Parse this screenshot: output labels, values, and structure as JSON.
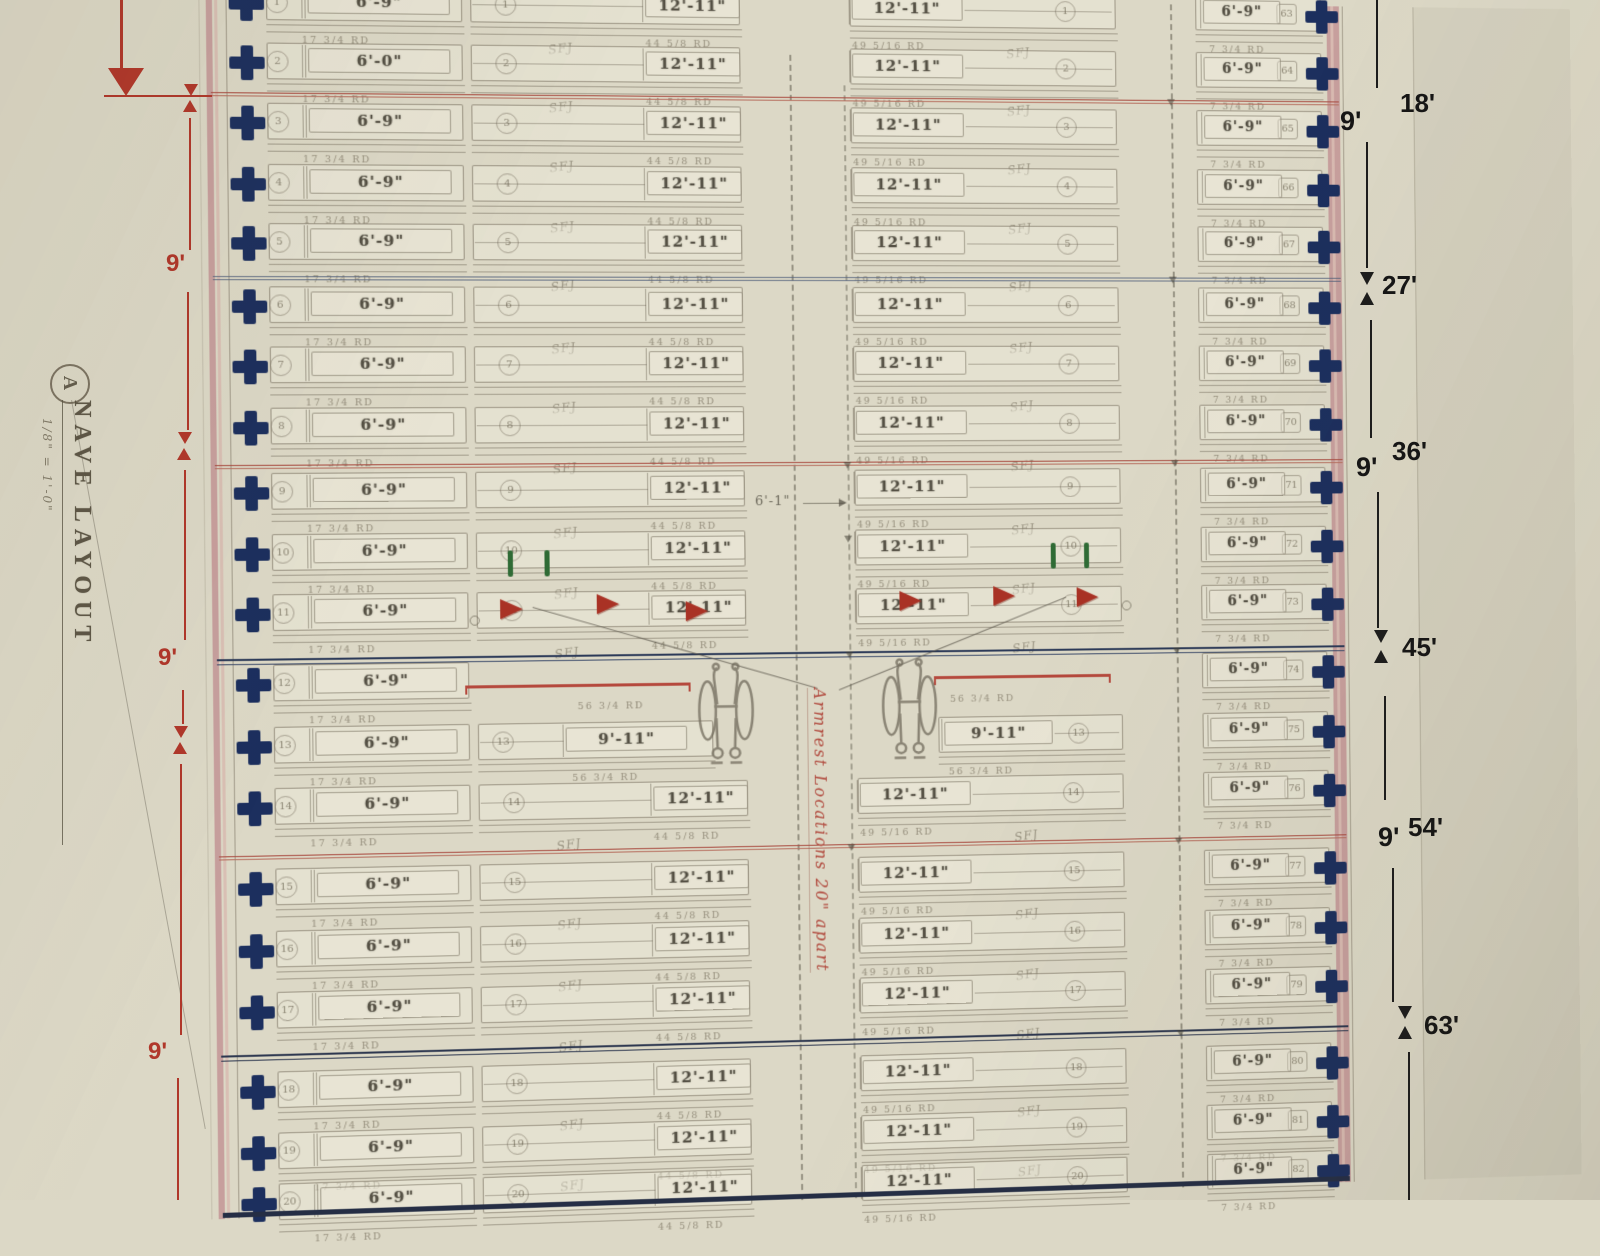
{
  "sheet": {
    "title_block": {
      "detail_letter": "A",
      "title": "NAVE LAYOUT",
      "scale": "1/8\" = 1'-0\""
    },
    "center_aisle_note": "Armrest Locations 20\" apart",
    "aisle_dimension_label": "6'-1\"",
    "between_row_mark": "SFJ"
  },
  "left_dimension_chain": {
    "segment_labels": [
      "9'",
      "9'",
      "9'"
    ]
  },
  "right_dimension_chain": {
    "marks": [
      {
        "cumulative": "18'",
        "segment": "9'"
      },
      {
        "cumulative": "27'"
      },
      {
        "cumulative": "36'",
        "segment": "9'"
      },
      {
        "cumulative": "45'"
      },
      {
        "cumulative": "54'",
        "segment": "9'"
      },
      {
        "cumulative": "63'"
      }
    ]
  },
  "pew_rows": [
    {
      "left": {
        "num": "1",
        "label": "6'-9\"",
        "sub": "17 3/4 RD"
      },
      "center_left": {
        "num": "1",
        "label": "12'-11\"",
        "sub": "44 5/8 RD"
      },
      "center_right": {
        "label": "12'-11\"",
        "num": "1",
        "sub": "49 5/16 RD"
      },
      "right": {
        "label": "6'-9\"",
        "num": "63",
        "sub": "7 3/4 RD"
      },
      "sfj": true
    },
    {
      "left": {
        "num": "2",
        "label": "6'-0\"",
        "sub": "17 3/4 RD"
      },
      "center_left": {
        "num": "2",
        "label": "12'-11\"",
        "sub": "44 5/8 RD"
      },
      "center_right": {
        "label": "12'-11\"",
        "num": "2",
        "sub": "49 5/16 RD"
      },
      "right": {
        "label": "6'-9\"",
        "num": "64",
        "sub": "7 3/4 RD"
      },
      "sfj": true
    },
    {
      "left": {
        "num": "3",
        "label": "6'-9\"",
        "sub": "17 3/4 RD"
      },
      "center_left": {
        "num": "3",
        "label": "12'-11\"",
        "sub": "44 5/8 RD"
      },
      "center_right": {
        "label": "12'-11\"",
        "num": "3",
        "sub": "49 5/16 RD"
      },
      "right": {
        "label": "6'-9\"",
        "num": "65",
        "sub": "7 3/4 RD"
      },
      "sfj": true
    },
    {
      "left": {
        "num": "4",
        "label": "6'-9\"",
        "sub": "17 3/4 RD"
      },
      "center_left": {
        "num": "4",
        "label": "12'-11\"",
        "sub": "44 5/8 RD"
      },
      "center_right": {
        "label": "12'-11\"",
        "num": "4",
        "sub": "49 5/16 RD"
      },
      "right": {
        "label": "6'-9\"",
        "num": "66",
        "sub": "7 3/4 RD"
      },
      "sfj": true
    },
    {
      "left": {
        "num": "5",
        "label": "6'-9\"",
        "sub": "17 3/4 RD"
      },
      "center_left": {
        "num": "5",
        "label": "12'-11\"",
        "sub": "44 5/8 RD"
      },
      "center_right": {
        "label": "12'-11\"",
        "num": "5",
        "sub": "49 5/16 RD"
      },
      "right": {
        "label": "6'-9\"",
        "num": "67",
        "sub": "7 3/4 RD"
      },
      "sfj": true
    },
    {
      "left": {
        "num": "6",
        "label": "6'-9\"",
        "sub": "17 3/4 RD"
      },
      "center_left": {
        "num": "6",
        "label": "12'-11\"",
        "sub": "44 5/8 RD"
      },
      "center_right": {
        "label": "12'-11\"",
        "num": "6",
        "sub": "49 5/16 RD"
      },
      "right": {
        "label": "6'-9\"",
        "num": "68",
        "sub": "7 3/4 RD"
      },
      "sfj": true
    },
    {
      "left": {
        "num": "7",
        "label": "6'-9\"",
        "sub": "17 3/4 RD"
      },
      "center_left": {
        "num": "7",
        "label": "12'-11\"",
        "sub": "44 5/8 RD"
      },
      "center_right": {
        "label": "12'-11\"",
        "num": "7",
        "sub": "49 5/16 RD"
      },
      "right": {
        "label": "6'-9\"",
        "num": "69",
        "sub": "7 3/4 RD"
      },
      "sfj": true
    },
    {
      "left": {
        "num": "8",
        "label": "6'-9\"",
        "sub": "17 3/4 RD"
      },
      "center_left": {
        "num": "8",
        "label": "12'-11\"",
        "sub": "44 5/8 RD"
      },
      "center_right": {
        "label": "12'-11\"",
        "num": "8",
        "sub": "49 5/16 RD"
      },
      "right": {
        "label": "6'-9\"",
        "num": "70",
        "sub": "7 3/4 RD"
      },
      "sfj": true
    },
    {
      "left": {
        "num": "9",
        "label": "6'-9\"",
        "sub": "17 3/4 RD"
      },
      "center_left": {
        "num": "9",
        "label": "12'-11\"",
        "sub": "44 5/8 RD"
      },
      "center_right": {
        "label": "12'-11\"",
        "num": "9",
        "sub": "49 5/16 RD"
      },
      "right": {
        "label": "6'-9\"",
        "num": "71",
        "sub": "7 3/4 RD"
      },
      "sfj": true
    },
    {
      "left": {
        "num": "10",
        "label": "6'-9\"",
        "sub": "17 3/4 RD"
      },
      "center_left": {
        "num": "10",
        "label": "12'-11\"",
        "sub": "44 5/8 RD"
      },
      "center_right": {
        "label": "12'-11\"",
        "num": "10",
        "sub": "49 5/16 RD"
      },
      "right": {
        "label": "6'-9\"",
        "num": "72",
        "sub": "7 3/4 RD"
      },
      "sfj": true
    },
    {
      "left": {
        "num": "11",
        "label": "6'-9\"",
        "sub": "17 3/4 RD"
      },
      "center_left": {
        "num": "11",
        "label": "12'-11\"",
        "sub": "44 5/8 RD"
      },
      "center_right": {
        "label": "12'-11\"",
        "num": "11",
        "sub": "49 5/16 RD"
      },
      "right": {
        "label": "6'-9\"",
        "num": "73",
        "sub": "7 3/4 RD"
      },
      "sfj": true
    },
    {
      "left": {
        "num": "12",
        "label": "6'-9\"",
        "sub": "17 3/4 RD"
      },
      "center_left": null,
      "center_right": null,
      "bracket_sub": "56 3/4 RD",
      "right": {
        "label": "6'-9\"",
        "num": "74",
        "sub": "7 3/4 RD"
      },
      "sfj": false
    },
    {
      "left": {
        "num": "13",
        "label": "6'-9\"",
        "sub": "17 3/4 RD"
      },
      "center_left": {
        "num": "13",
        "label": "9'-11\"",
        "sub": "56 3/4 RD"
      },
      "center_right": {
        "label": "9'-11\"",
        "num": "13",
        "sub": "56 3/4 RD"
      },
      "right": {
        "label": "6'-9\"",
        "num": "75",
        "sub": "7 3/4 RD"
      },
      "sfj": false
    },
    {
      "left": {
        "num": "14",
        "label": "6'-9\"",
        "sub": "17 3/4 RD"
      },
      "center_left": {
        "num": "14",
        "label": "12'-11\"",
        "sub": "44 5/8 RD"
      },
      "center_right": {
        "label": "12'-11\"",
        "num": "14",
        "sub": "49 5/16 RD"
      },
      "right": {
        "label": "6'-9\"",
        "num": "76",
        "sub": "7 3/4 RD"
      },
      "sfj": true
    },
    {
      "left": {
        "num": "15",
        "label": "6'-9\"",
        "sub": "17 3/4 RD"
      },
      "center_left": {
        "num": "15",
        "label": "12'-11\"",
        "sub": "44 5/8 RD"
      },
      "center_right": {
        "label": "12'-11\"",
        "num": "15",
        "sub": "49 5/16 RD"
      },
      "right": {
        "label": "6'-9\"",
        "num": "77",
        "sub": "7 3/4 RD"
      },
      "sfj": true
    },
    {
      "left": {
        "num": "16",
        "label": "6'-9\"",
        "sub": "17 3/4 RD"
      },
      "center_left": {
        "num": "16",
        "label": "12'-11\"",
        "sub": "44 5/8 RD"
      },
      "center_right": {
        "label": "12'-11\"",
        "num": "16",
        "sub": "49 5/16 RD"
      },
      "right": {
        "label": "6'-9\"",
        "num": "78",
        "sub": "7 3/4 RD"
      },
      "sfj": true
    },
    {
      "left": {
        "num": "17",
        "label": "6'-9\"",
        "sub": "17 3/4 RD"
      },
      "center_left": {
        "num": "17",
        "label": "12'-11\"",
        "sub": "44 5/8 RD"
      },
      "center_right": {
        "label": "12'-11\"",
        "num": "17",
        "sub": "49 5/16 RD"
      },
      "right": {
        "label": "6'-9\"",
        "num": "79",
        "sub": "7 3/4 RD"
      },
      "sfj": true
    },
    {
      "left": {
        "num": "18",
        "label": "6'-9\"",
        "sub": "17 3/4 RD"
      },
      "center_left": {
        "num": "18",
        "label": "12'-11\"",
        "sub": "44 5/8 RD"
      },
      "center_right": {
        "label": "12'-11\"",
        "num": "18",
        "sub": "49 5/16 RD"
      },
      "right": {
        "label": "6'-9\"",
        "num": "80",
        "sub": "7 3/4 RD"
      },
      "sfj": true
    },
    {
      "left": {
        "num": "19",
        "label": "6'-9\"",
        "sub": "17 3/4 RD"
      },
      "center_left": {
        "num": "19",
        "label": "12'-11\"",
        "sub": "44 5/8 RD"
      },
      "center_right": {
        "label": "12'-11\"",
        "num": "19",
        "sub": "49 5/16 RD"
      },
      "right": {
        "label": "6'-9\"",
        "num": "81",
        "sub": "7 3/4 RD"
      },
      "sfj": true
    },
    {
      "left": {
        "num": "20",
        "label": "6'-9\"",
        "sub": "17 3/4 RD"
      },
      "center_left": {
        "num": "20",
        "label": "12'-11\"",
        "sub": "44 5/8 RD"
      },
      "center_right": {
        "label": "12'-11\"",
        "num": "20",
        "sub": "49 5/16 RD"
      },
      "right": {
        "label": "6'-9\"",
        "num": "82",
        "sub": "7 3/4 RD"
      },
      "sfj": false
    }
  ],
  "colors": {
    "cross_marker": "#1c2f5e",
    "annotation_red": "#b0372a",
    "section_line_red": "#a8493e",
    "section_line_blue": "#2c3a58",
    "green_tick": "#2f6b35",
    "paper": "#dcd8c6",
    "pink_border": "#c79f9d"
  }
}
